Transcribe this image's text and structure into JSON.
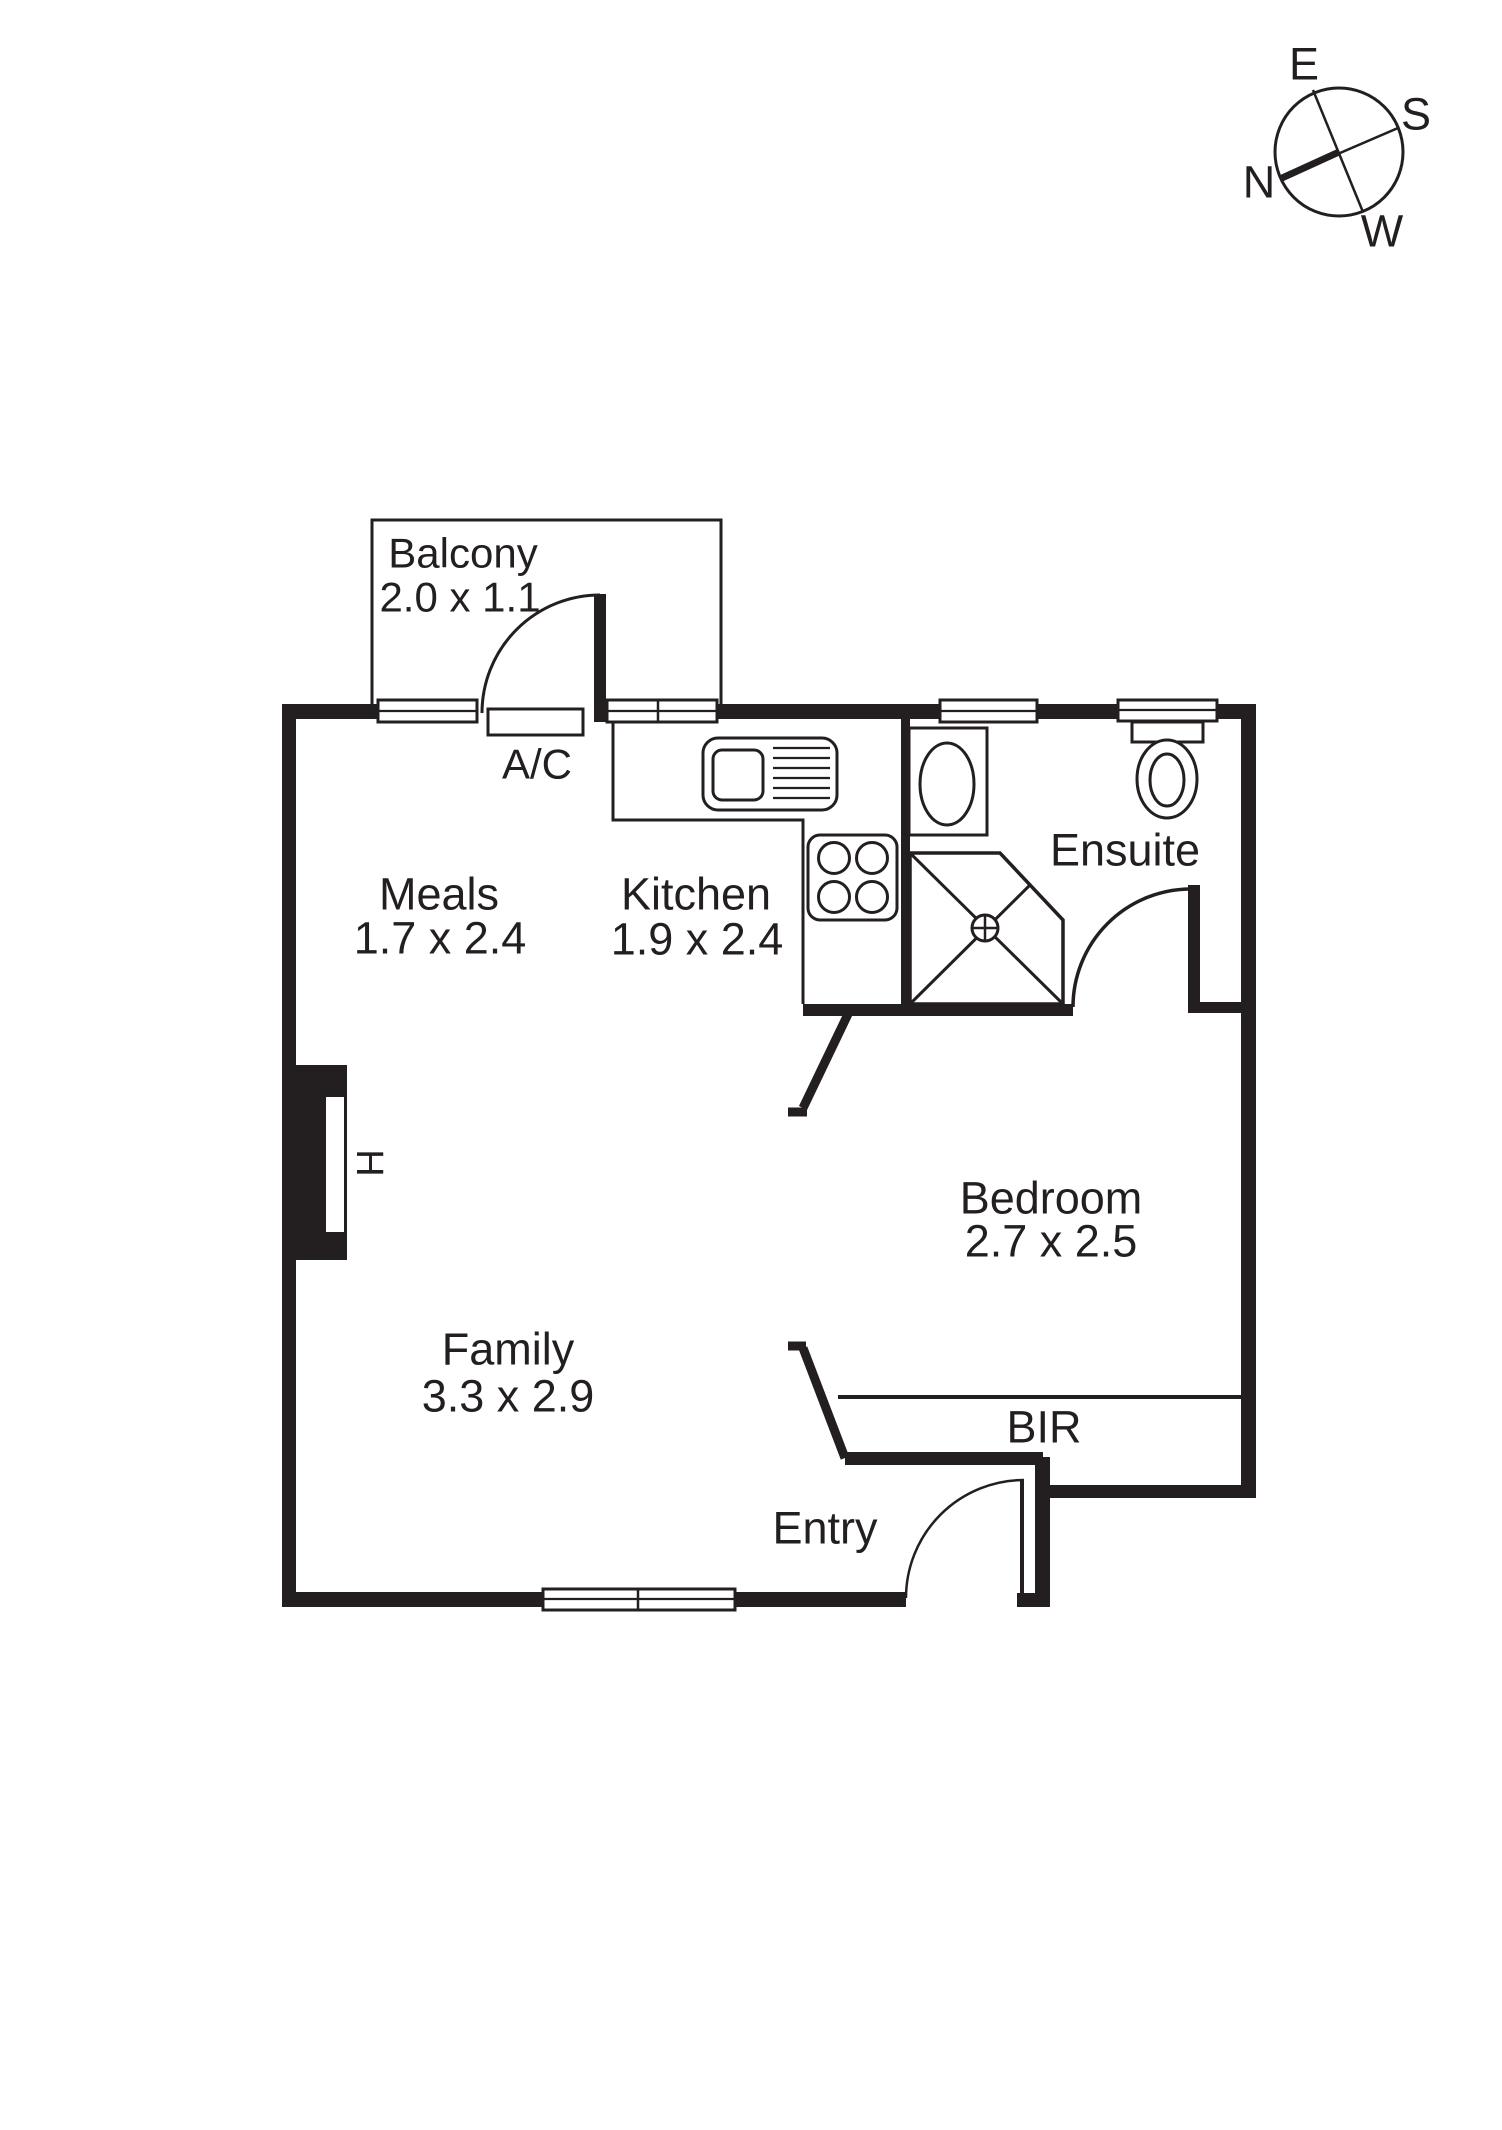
{
  "compass": {
    "east": "E",
    "south": "S",
    "north": "N",
    "west": "W"
  },
  "rooms": {
    "balcony": {
      "name": "Balcony",
      "dims": "2.0 x 1.1"
    },
    "meals": {
      "name": "Meals",
      "dims": "1.7 x 2.4"
    },
    "kitchen": {
      "name": "Kitchen",
      "dims": "1.9 x 2.4"
    },
    "ensuite": {
      "name": "Ensuite"
    },
    "bedroom": {
      "name": "Bedroom",
      "dims": "2.7 x 2.5"
    },
    "family": {
      "name": "Family",
      "dims": "3.3 x 2.9"
    }
  },
  "labels": {
    "ac": "A/C",
    "bir": "BIR",
    "entry": "Entry",
    "heater": "H"
  },
  "colors": {
    "ink": "#231f20",
    "paper": "#ffffff"
  }
}
